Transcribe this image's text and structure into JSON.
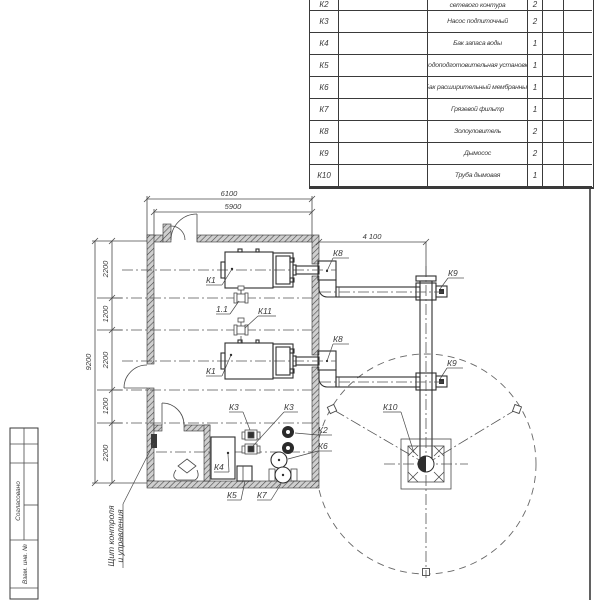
{
  "parts_table": {
    "rows": [
      {
        "pos": "К2",
        "name": "сетевого контура",
        "qty": "2"
      },
      {
        "pos": "К3",
        "name": "Насос подпиточный",
        "qty": "2"
      },
      {
        "pos": "К4",
        "name": "Бак запаса воды",
        "qty": "1"
      },
      {
        "pos": "К5",
        "name": "Водоподготовительная установка",
        "qty": "1"
      },
      {
        "pos": "К6",
        "name": "Бак расширительный мембранный",
        "qty": "1"
      },
      {
        "pos": "К7",
        "name": "Грязевой фильтр",
        "qty": "1"
      },
      {
        "pos": "К8",
        "name": "Золоуловитель",
        "qty": "2"
      },
      {
        "pos": "К9",
        "name": "Дымосос",
        "qty": "2"
      },
      {
        "pos": "К10",
        "name": "Труба дымовая",
        "qty": "1"
      }
    ]
  },
  "dimensions": {
    "width_outer": "6100",
    "width_inner": "5900",
    "flue_offset": "4 100",
    "height_overall": "9200",
    "chain": [
      "2200",
      "1200",
      "2200",
      "1200",
      "2200"
    ]
  },
  "labels": {
    "k1a": "К1",
    "k1b": "К1",
    "k2": "К2",
    "k3a": "К3",
    "k3b": "К3",
    "k4": "К4",
    "k5": "К5",
    "k6": "К6",
    "k7": "К7",
    "k8a": "К8",
    "k8b": "К8",
    "k9a": "К9",
    "k9b": "К9",
    "k10": "К10",
    "k11": "К11",
    "v11": "1.1"
  },
  "callout": {
    "line1": "Щит контроля",
    "line2": "и управления"
  },
  "title_strip": {
    "agreed": "Согласовано",
    "inv": "Взам. инв. №"
  },
  "colors": {
    "line": "#3a3a3a",
    "wall_fill": "#cfcfcf"
  }
}
